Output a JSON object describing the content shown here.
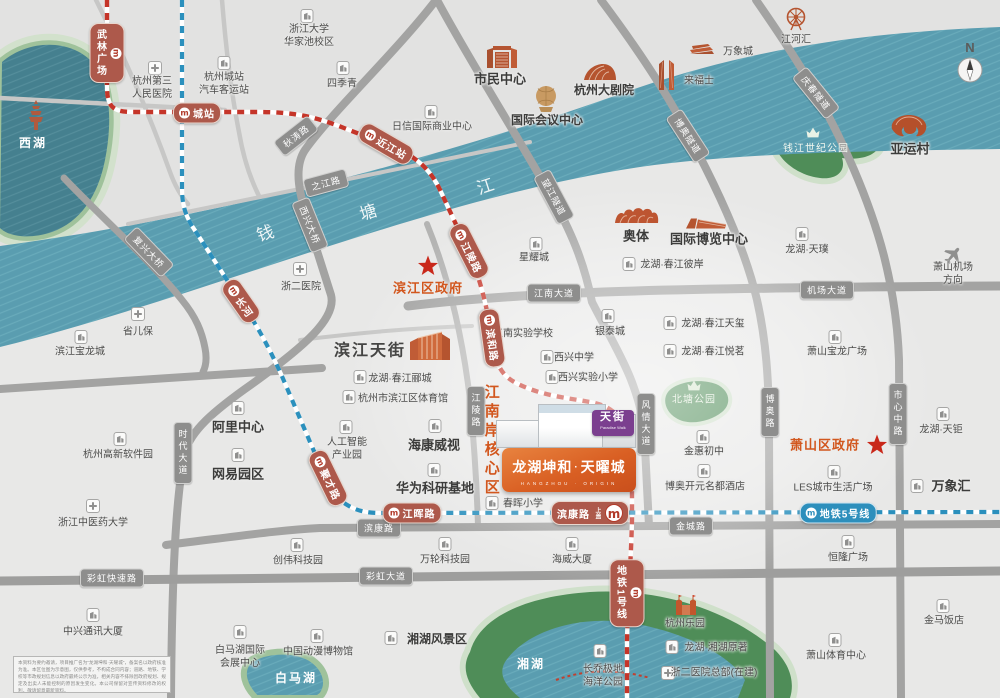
{
  "colors": {
    "river": "#5a9db0",
    "park_deep": "#4f8d58",
    "road_dark": "#a3a3a2",
    "road_light": "#c7c7c6",
    "metro_line1": "#c53529",
    "metro_line5": "#2b90bd",
    "accent_orange": "#d2571e",
    "star_red": "#c9281a"
  },
  "compass": {
    "n": "N"
  },
  "property": {
    "brand": "龙湖坤和",
    "sep": "·",
    "name": "天曜城",
    "sub": "HANGZHOU · ORIGIN",
    "mall_logo": "天街",
    "mall_logo_sub": "Paradise Walk"
  },
  "disclaimer": {
    "text": "本资料为要约邀请，项目推广名为“龙湖坤和·天曜城”，备案名以政府核准为准。本区位图为示意图，仅供参考，不构成合同内容；道路、地铁、学校等市政规划信息以政府最终公示为准，相关内容不排除因政府规划、规定及出卖人未能控制的原因发生变化。本公司保留对宣传资料修改的权利，敬请留意最新资料。"
  },
  "map": {
    "metro_logo": "m",
    "river_name": [
      {
        "t": "钱",
        "x": 266,
        "y": 234,
        "rot": -18
      },
      {
        "t": "塘",
        "x": 369,
        "y": 213,
        "rot": -18
      },
      {
        "t": "江",
        "x": 486,
        "y": 187,
        "rot": -18
      }
    ],
    "metro_lines": [
      {
        "name": "地铁1号线",
        "color": "#c53529"
      },
      {
        "name": "地铁5号线",
        "color": "#2b90bd"
      }
    ],
    "road_labels": [
      {
        "t": "秋涛路",
        "x": 296,
        "y": 136,
        "rot": -38
      },
      {
        "t": "之江路",
        "x": 326,
        "y": 183,
        "rot": -15
      },
      {
        "t": "西兴大桥",
        "x": 310,
        "y": 225,
        "rot": 68
      },
      {
        "t": "复兴大桥",
        "x": 149,
        "y": 252,
        "rot": 46
      },
      {
        "t": "望江隧道",
        "x": 554,
        "y": 197,
        "rot": 62
      },
      {
        "t": "博奥隧道",
        "x": 688,
        "y": 136,
        "rot": 57
      },
      {
        "t": "庆春隧道",
        "x": 816,
        "y": 93,
        "rot": 51
      },
      {
        "t": "江南大道",
        "x": 554,
        "y": 293,
        "rot": 0
      },
      {
        "t": "机场大道",
        "x": 827,
        "y": 290,
        "rot": 0
      },
      {
        "t": "时代大道",
        "x": 183,
        "y": 453,
        "rot": 90
      },
      {
        "t": "江陵路",
        "x": 476,
        "y": 411,
        "rot": 90
      },
      {
        "t": "风情大道",
        "x": 646,
        "y": 424,
        "rot": 90
      },
      {
        "t": "博奥路",
        "x": 770,
        "y": 412,
        "rot": 90
      },
      {
        "t": "市心中路",
        "x": 898,
        "y": 414,
        "rot": 90
      },
      {
        "t": "滨康路",
        "x": 379,
        "y": 528,
        "rot": 0
      },
      {
        "t": "金城路",
        "x": 691,
        "y": 526,
        "rot": 0
      },
      {
        "t": "彩虹快速路",
        "x": 112,
        "y": 578,
        "rot": 0
      },
      {
        "t": "彩虹大道",
        "x": 386,
        "y": 576,
        "rot": 0
      }
    ],
    "stations": [
      {
        "t": "武林广场",
        "x": 107,
        "y": 53,
        "kind": "v"
      },
      {
        "t": "城站",
        "x": 197,
        "y": 113,
        "kind": "h"
      },
      {
        "t": "近江站",
        "x": 386,
        "y": 144,
        "kind": "r",
        "rot": 30
      },
      {
        "t": "江陵路",
        "x": 469,
        "y": 251,
        "kind": "r",
        "rot": 63
      },
      {
        "t": "滨和路",
        "x": 492,
        "y": 338,
        "kind": "r",
        "rot": 82
      },
      {
        "t": "长河",
        "x": 241,
        "y": 301,
        "kind": "r",
        "rot": 55
      },
      {
        "t": "聚才路",
        "x": 328,
        "y": 478,
        "kind": "r",
        "rot": 64
      },
      {
        "t": "江晖路",
        "x": 412,
        "y": 513,
        "kind": "h"
      },
      {
        "t": "滨康路",
        "x": 590,
        "y": 513,
        "kind": "big",
        "sub": "上盖"
      },
      {
        "t": "地铁5号线",
        "x": 838,
        "y": 513,
        "kind": "h",
        "line": "5"
      },
      {
        "t": "地铁1号线",
        "x": 627,
        "y": 593,
        "kind": "v"
      }
    ],
    "places": [
      {
        "t": "西湖",
        "x": 33,
        "y": 144,
        "c": "wlab",
        "ic": "pagoda",
        "ix": 36,
        "iy": 115
      },
      {
        "t": "杭州第三\n人民医院",
        "x": 152,
        "y": 88,
        "ic": "h",
        "ix": 155,
        "iy": 68
      },
      {
        "t": "杭州城站\n汽车客运站",
        "x": 224,
        "y": 84,
        "ic": "b",
        "ix": 224,
        "iy": 63
      },
      {
        "t": "浙江大学\n华家池校区",
        "x": 309,
        "y": 36,
        "ic": "b",
        "ix": 307,
        "iy": 16
      },
      {
        "t": "四季青",
        "x": 342,
        "y": 84,
        "ic": "b",
        "ix": 343,
        "iy": 68
      },
      {
        "t": "日信国际商业中心",
        "x": 432,
        "y": 127,
        "ic": "b",
        "ix": 431,
        "iy": 112
      },
      {
        "t": "市民中心",
        "x": 500,
        "y": 80,
        "c": "big",
        "ic": "civic",
        "ix": 502,
        "iy": 56
      },
      {
        "t": "杭州大剧院",
        "x": 604,
        "y": 91,
        "c": "b12",
        "ic": "theater",
        "ix": 600,
        "iy": 72
      },
      {
        "t": "国际会议中心",
        "x": 547,
        "y": 121,
        "c": "b12",
        "ic": "sphere",
        "ix": 546,
        "iy": 99
      },
      {
        "t": "来福士",
        "x": 699,
        "y": 81,
        "ic": "towers",
        "ix": 667,
        "iy": 74
      },
      {
        "t": "万象城",
        "x": 738,
        "y": 52,
        "ic": "mallsm",
        "ix": 702,
        "iy": 49
      },
      {
        "t": "江河汇",
        "x": 796,
        "y": 40,
        "ic": "wheel",
        "ix": 796,
        "iy": 19
      },
      {
        "t": "亚运村",
        "x": 910,
        "y": 150,
        "c": "big",
        "ic": "asian",
        "ix": 909,
        "iy": 126
      },
      {
        "t": "钱江世纪公园",
        "x": 816,
        "y": 149,
        "c": "wsm",
        "ic": "crown",
        "ix": 813,
        "iy": 133
      },
      {
        "t": "萧山机场方向",
        "x": 953,
        "y": 274,
        "ic": "plane",
        "ix": 953,
        "iy": 255
      },
      {
        "t": "浙二医院",
        "x": 301,
        "y": 287,
        "ic": "h",
        "ix": 300,
        "iy": 269
      },
      {
        "t": "省儿保",
        "x": 138,
        "y": 332,
        "ic": "h",
        "ix": 138,
        "iy": 314
      },
      {
        "t": "滨江宝龙城",
        "x": 80,
        "y": 352,
        "ic": "b",
        "ix": 81,
        "iy": 337
      },
      {
        "t": "滨江区政府",
        "x": 428,
        "y": 289,
        "c": "gov",
        "ic": "star",
        "ix": 428,
        "iy": 266
      },
      {
        "t": "星耀城",
        "x": 534,
        "y": 258,
        "ic": "b",
        "ix": 536,
        "iy": 244
      },
      {
        "t": "奥体",
        "x": 636,
        "y": 237,
        "c": "big",
        "ic": "stadium",
        "ix": 637,
        "iy": 216
      },
      {
        "t": "国际博览中心",
        "x": 709,
        "y": 240,
        "c": "big",
        "ic": "expo",
        "ix": 707,
        "iy": 223
      },
      {
        "t": "龙湖·春江彼岸",
        "x": 672,
        "y": 265,
        "ic": "b",
        "ix": 629,
        "iy": 264
      },
      {
        "t": "龙湖·天璞",
        "x": 807,
        "y": 250,
        "ic": "b",
        "ix": 802,
        "iy": 234
      },
      {
        "t": "江南实验学校",
        "x": 523,
        "y": 334,
        "ic": "b",
        "ix": 490,
        "iy": 333
      },
      {
        "t": "银泰城",
        "x": 610,
        "y": 332,
        "ic": "b",
        "ix": 608,
        "iy": 316
      },
      {
        "t": "西兴中学",
        "x": 574,
        "y": 358,
        "ic": "b",
        "ix": 547,
        "iy": 357
      },
      {
        "t": "西兴实验小学",
        "x": 588,
        "y": 378,
        "ic": "b",
        "ix": 552,
        "iy": 377
      },
      {
        "t": "龙湖·春江天玺",
        "x": 713,
        "y": 324,
        "ic": "b",
        "ix": 670,
        "iy": 323
      },
      {
        "t": "龙湖·春江悦茗",
        "x": 713,
        "y": 352,
        "ic": "b",
        "ix": 670,
        "iy": 351
      },
      {
        "t": "萧山宝龙广场",
        "x": 837,
        "y": 352,
        "ic": "b",
        "ix": 835,
        "iy": 337
      },
      {
        "t": "北塘公园",
        "x": 694,
        "y": 400,
        "c": "wsm",
        "ic": "crown",
        "ix": 694,
        "iy": 386
      },
      {
        "t": "萧山区政府",
        "x": 825,
        "y": 446,
        "c": "gov"
      },
      {
        "t": "",
        "x": 877,
        "y": 445,
        "ic": "star",
        "ix": 877,
        "iy": 445
      },
      {
        "t": "龙湖·天钜",
        "x": 941,
        "y": 430,
        "ic": "b",
        "ix": 943,
        "iy": 414
      },
      {
        "t": "金惠初中",
        "x": 704,
        "y": 452,
        "ic": "b",
        "ix": 703,
        "iy": 437
      },
      {
        "t": "博奥开元名都酒店",
        "x": 705,
        "y": 487,
        "ic": "b",
        "ix": 704,
        "iy": 471
      },
      {
        "t": "LES城市生活广场",
        "x": 833,
        "y": 488,
        "ic": "b",
        "ix": 834,
        "iy": 472
      },
      {
        "t": "万象汇",
        "x": 951,
        "y": 487,
        "c": "big",
        "ic": "b",
        "ix": 917,
        "iy": 486
      },
      {
        "t": "滨江天街",
        "x": 370,
        "y": 352,
        "c": "xl",
        "ic": "mallbig",
        "ix": 430,
        "iy": 345
      },
      {
        "t": "龙湖·春江郦城",
        "x": 400,
        "y": 379,
        "ic": "b",
        "ix": 360,
        "iy": 377
      },
      {
        "t": "杭州市滨江区体育馆",
        "x": 403,
        "y": 399,
        "ic": "b",
        "ix": 349,
        "iy": 397
      },
      {
        "t": "人工智能\n产业园",
        "x": 347,
        "y": 449,
        "ic": "b",
        "ix": 346,
        "iy": 427
      },
      {
        "t": "海康威视",
        "x": 434,
        "y": 446,
        "c": "big",
        "ic": "b",
        "ix": 435,
        "iy": 426
      },
      {
        "t": "华为科研基地",
        "x": 435,
        "y": 489,
        "c": "big",
        "ic": "b",
        "ix": 434,
        "iy": 470
      },
      {
        "t": "阿里中心",
        "x": 238,
        "y": 428,
        "c": "big",
        "ic": "b",
        "ix": 238,
        "iy": 408
      },
      {
        "t": "网易园区",
        "x": 238,
        "y": 475,
        "c": "big",
        "ic": "b",
        "ix": 238,
        "iy": 455
      },
      {
        "t": "杭州高新软件园",
        "x": 118,
        "y": 455,
        "ic": "b",
        "ix": 120,
        "iy": 439
      },
      {
        "t": "浙江中医药大学",
        "x": 93,
        "y": 523,
        "ic": "h",
        "ix": 93,
        "iy": 506
      },
      {
        "t": "中兴通讯大厦",
        "x": 93,
        "y": 632,
        "ic": "b",
        "ix": 93,
        "iy": 615
      },
      {
        "t": "创伟科技园",
        "x": 298,
        "y": 561,
        "ic": "b",
        "ix": 297,
        "iy": 545
      },
      {
        "t": "万轮科技园",
        "x": 445,
        "y": 560,
        "ic": "b",
        "ix": 445,
        "iy": 544
      },
      {
        "t": "海威大厦",
        "x": 572,
        "y": 560,
        "ic": "b",
        "ix": 572,
        "iy": 544
      },
      {
        "t": "恒隆广场",
        "x": 848,
        "y": 558,
        "ic": "b",
        "ix": 848,
        "iy": 542
      },
      {
        "t": "春晖小学",
        "x": 523,
        "y": 504,
        "ic": "b",
        "ix": 492,
        "iy": 503
      },
      {
        "t": "江南岸核心区",
        "x": 491,
        "y": 441,
        "c": "core"
      },
      {
        "t": "湘湖风景区",
        "x": 437,
        "y": 640,
        "c": "b12",
        "ic": "b",
        "ix": 391,
        "iy": 638
      },
      {
        "t": "中国动漫博物馆",
        "x": 318,
        "y": 652,
        "ic": "b",
        "ix": 317,
        "iy": 636
      },
      {
        "t": "白马湖国际\n会展中心",
        "x": 240,
        "y": 657,
        "ic": "b",
        "ix": 240,
        "iy": 632
      },
      {
        "t": "白马湖",
        "x": 296,
        "y": 679,
        "c": "wlab"
      },
      {
        "t": "湘湖",
        "x": 531,
        "y": 665,
        "c": "wlab"
      },
      {
        "t": "长乔极地\n海洋公园",
        "x": 603,
        "y": 676,
        "ic": "b",
        "ix": 600,
        "iy": 651
      },
      {
        "t": "杭州乐园",
        "x": 685,
        "y": 624,
        "ic": "castle",
        "ix": 686,
        "iy": 604
      },
      {
        "t": "龙湖·湘湖原著",
        "x": 716,
        "y": 648,
        "ic": "b",
        "ix": 672,
        "iy": 647
      },
      {
        "t": "浙二医院总部(在建)",
        "x": 714,
        "y": 673,
        "ic": "h",
        "ix": 668,
        "iy": 673
      },
      {
        "t": "萧山体育中心",
        "x": 836,
        "y": 656,
        "ic": "b",
        "ix": 835,
        "iy": 640
      },
      {
        "t": "金马饭店",
        "x": 944,
        "y": 621,
        "ic": "b",
        "ix": 943,
        "iy": 606
      }
    ]
  }
}
